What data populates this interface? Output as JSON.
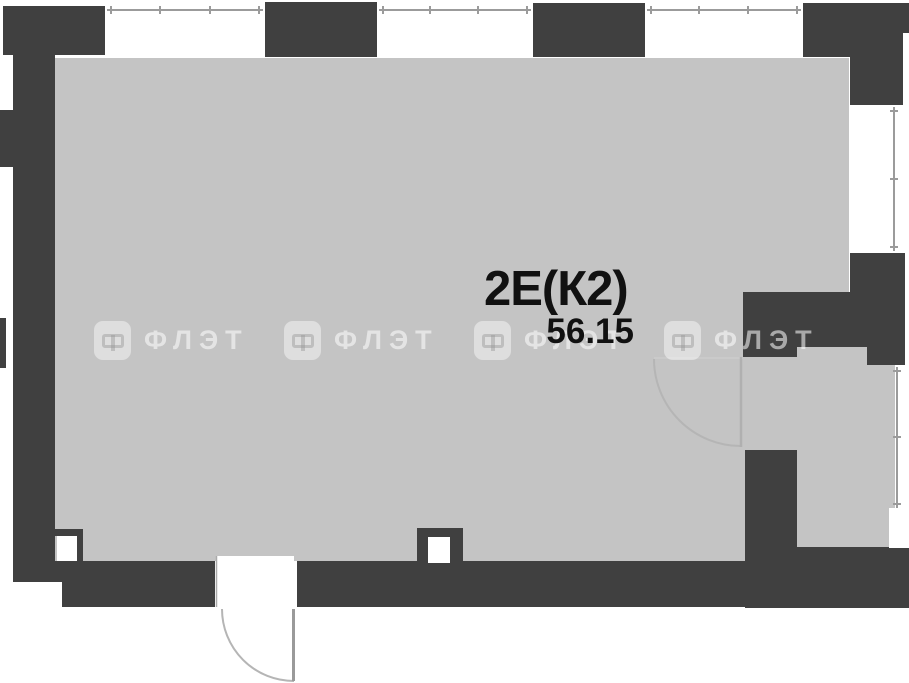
{
  "meta": {
    "type": "apartment-floor-plan",
    "width_px": 909,
    "height_px": 683
  },
  "unit": {
    "label": "2Е(К2)",
    "area": "56.15"
  },
  "watermark": {
    "text": "ФЛЭТ",
    "logo_icon": "flet-logo-rounded-square",
    "count": 4
  },
  "colors": {
    "background": "#ffffff",
    "wall": "#404040",
    "floor": "#c4c4c4",
    "label_text": "#111111",
    "window_line": "#9b9b9b",
    "door_arc": "#b5b5b5",
    "watermark": "rgba(255,255,255,0.55)"
  }
}
